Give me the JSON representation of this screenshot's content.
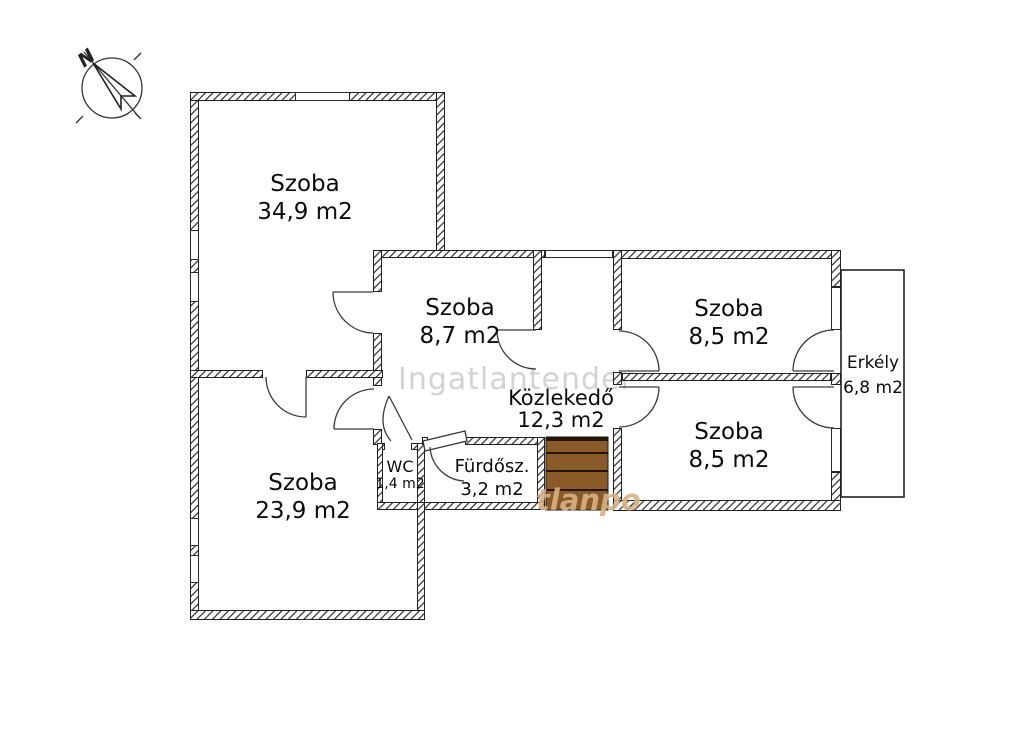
{
  "plan_title": "floor-plan",
  "compass": {
    "label": "N"
  },
  "rooms": [
    {
      "id": "szoba-349",
      "name": "Szoba",
      "area": "34,9 m2"
    },
    {
      "id": "szoba-87",
      "name": "Szoba",
      "area": "8,7 m2"
    },
    {
      "id": "szoba-85-top",
      "name": "Szoba",
      "area": "8,5 m2"
    },
    {
      "id": "szoba-85-bottom",
      "name": "Szoba",
      "area": "8,5 m2"
    },
    {
      "id": "szoba-239",
      "name": "Szoba",
      "area": "23,9 m2"
    },
    {
      "id": "kozlekedo",
      "name": "Közlekedő",
      "area": "12,3 m2"
    },
    {
      "id": "wc",
      "name": "WC",
      "area": "1,4 m2"
    },
    {
      "id": "furdoszoba",
      "name": "Fürdősz.",
      "area": "3,2 m2"
    },
    {
      "id": "erkely",
      "name": "Erkély",
      "area": "6,8 m2"
    }
  ],
  "watermarks": {
    "primary": "Ingatlantender",
    "secondary": "tlanpo"
  },
  "colors": {
    "stairs": "#8a5a28",
    "stairs_line": "#241507",
    "wall_line": "#222222",
    "watermark_gray": "#d3d3d3",
    "watermark_tan": "#d8b185"
  }
}
